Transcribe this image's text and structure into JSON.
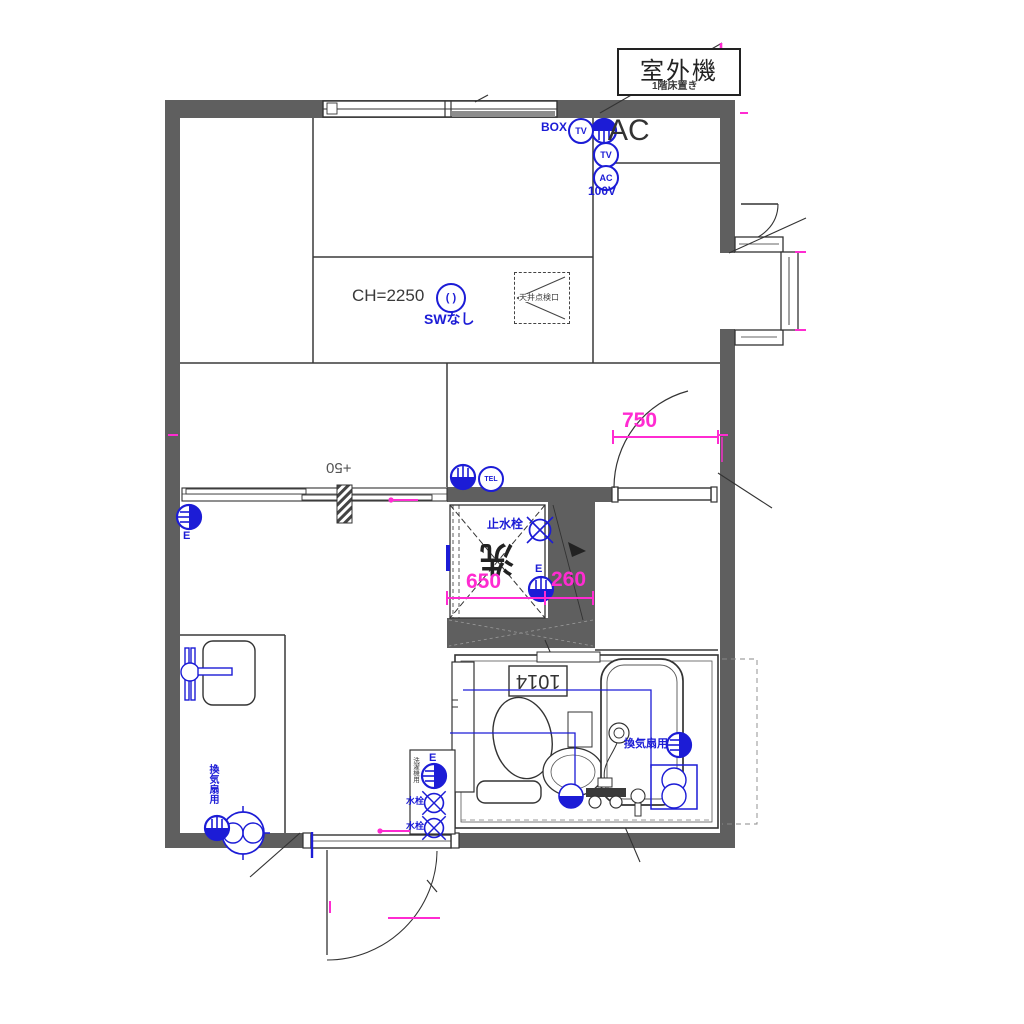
{
  "drawing": {
    "type": "apartment-floor-plan",
    "outdoor_unit": {
      "label": "室外機",
      "note": "1階床置き"
    },
    "ac_note": "AC",
    "electrical": {
      "box": "BOX",
      "tv": "TV",
      "ac": "AC",
      "voltage": "100V",
      "tel": "TEL",
      "earth": "E",
      "no_switch": "SWなし",
      "switch_glyph": "( )"
    },
    "ceiling": {
      "height": "CH=2250",
      "inspection_hatch": "天井点検口"
    },
    "floor_level": "+50",
    "plumbing": {
      "stop_valve": "止水栓",
      "laundry_mark": "洗",
      "tap": "水栓",
      "washer_note": "洗濯機用",
      "vent_fan": "換気扇用"
    },
    "dimensions": {
      "door_width": "750",
      "washer_space": "650",
      "side_gap": "260",
      "bath_unit": "1014"
    },
    "colors": {
      "wall": "#5f5f5f",
      "line": "#3a3a3a",
      "blue": "#1c1cd6",
      "magenta": "#ff2bd1"
    }
  }
}
